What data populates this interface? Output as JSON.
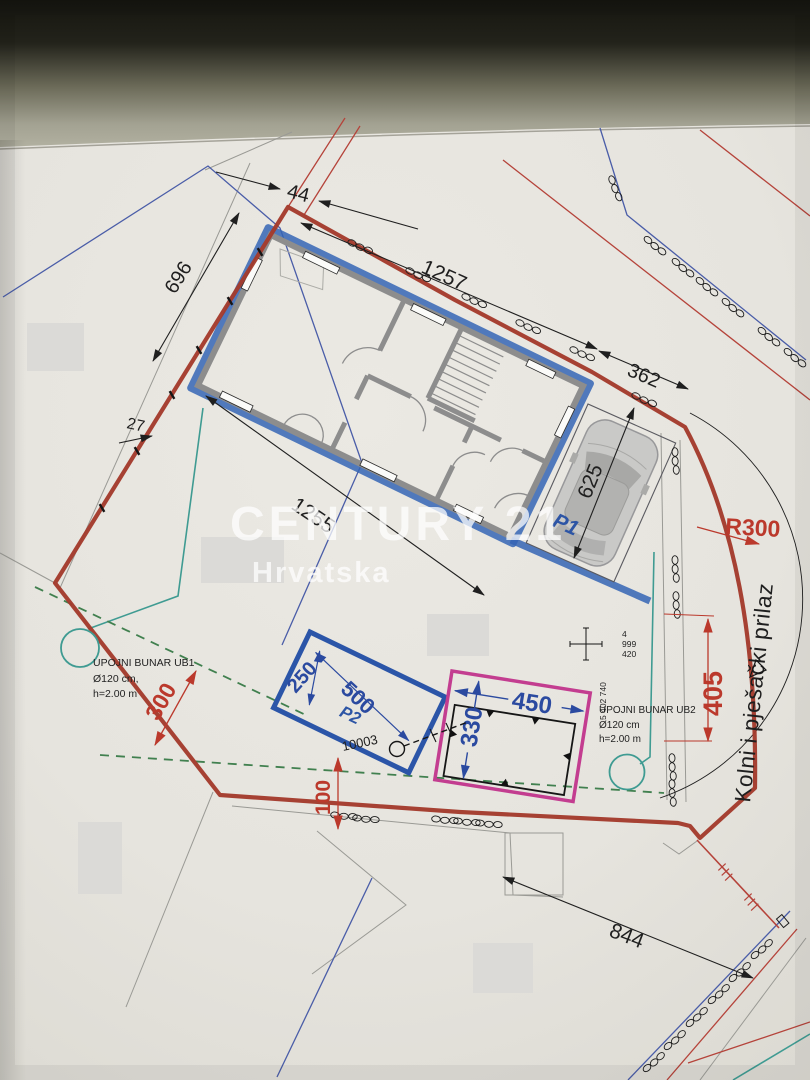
{
  "watermark": {
    "brand": "CENTURY 21",
    "region": "Hrvatska"
  },
  "plan": {
    "dimensions": {
      "d44": "44",
      "d696": "696",
      "d27": "27",
      "d1257": "1257",
      "d362": "362",
      "d1255": "1255",
      "d625": "625",
      "d844": "844",
      "d300": "300",
      "d100": "100",
      "d405": "405",
      "r300": "R300",
      "d500": "500",
      "d250": "250",
      "d450": "450",
      "d330": "330"
    },
    "labels": {
      "p1": "P1",
      "p2": "P2",
      "parcel_number": "10003",
      "coord_north_l1": "4",
      "coord_north_l2": "999",
      "coord_north_l3": "420",
      "coord_east": "5 402 740",
      "access_road": "Kolni i pješački prilaz"
    },
    "wells": {
      "ub1": {
        "name": "UPOJNI BUNAR UB1",
        "diameter": "Ø120 cm,",
        "depth": "h=2.00 m"
      },
      "ub2": {
        "name": "UPOJNI BUNAR UB2",
        "diameter": "Ø120 cm",
        "depth": "h=2.00 m"
      }
    },
    "colors": {
      "boundary_red": "#a33a2c",
      "marker_blue": "#3565b5",
      "magenta": "#c33d90",
      "teal": "#3f9b92",
      "green_dash": "#41804f",
      "dim_red": "#bb392c",
      "dim_blue": "#2b4aa0",
      "paper": "#e7e5df"
    }
  }
}
